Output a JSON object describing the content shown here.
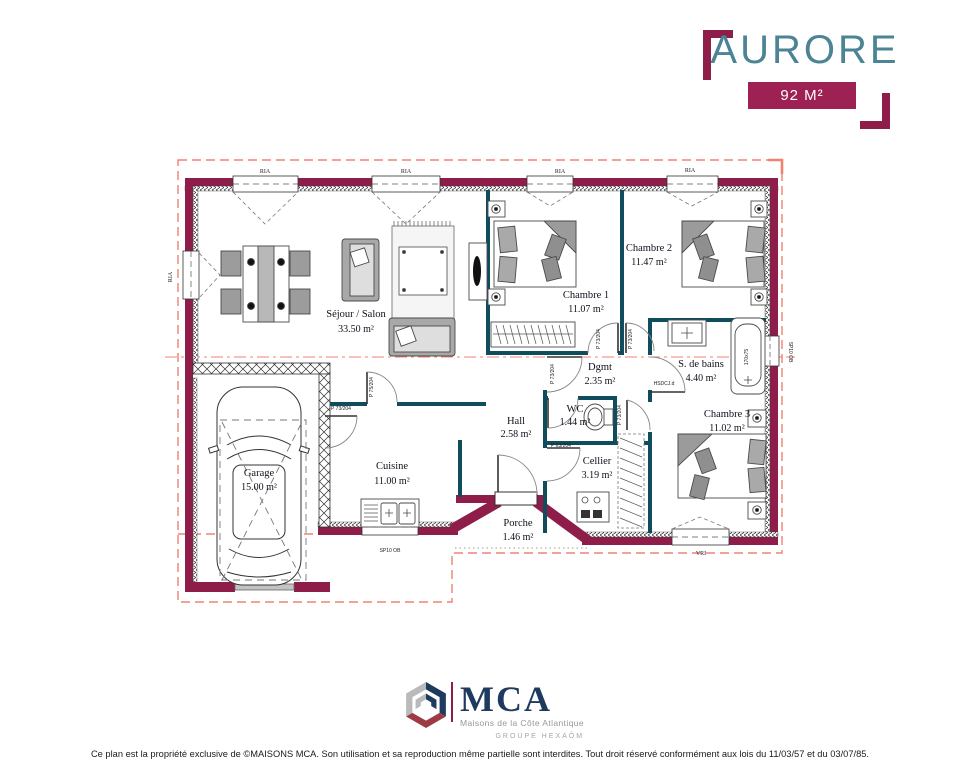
{
  "header": {
    "title": "AURORE",
    "area_badge": "92 M²"
  },
  "rooms": [
    {
      "name": "Séjour / Salon",
      "area": "33.50 m²"
    },
    {
      "name": "Chambre 1",
      "area": "11.07 m²"
    },
    {
      "name": "Chambre 2",
      "area": "11.47 m²"
    },
    {
      "name": "Chambre 3",
      "area": "11.02 m²"
    },
    {
      "name": "S. de bains",
      "area": "4.40 m²"
    },
    {
      "name": "Dgmt",
      "area": "2.35 m²"
    },
    {
      "name": "WC",
      "area": "1.44 m²"
    },
    {
      "name": "Hall",
      "area": "2.58 m²"
    },
    {
      "name": "Cuisine",
      "area": "11.00 m²"
    },
    {
      "name": "Cellier",
      "area": "3.19 m²"
    },
    {
      "name": "Porche",
      "area": "1.46 m²"
    },
    {
      "name": "Garage",
      "area": "15.00 m²"
    }
  ],
  "labels": {
    "window_top": "RIA",
    "window_side": "RIA",
    "window_roller": "VRI",
    "window_small": "SP10 OB",
    "door_73": "P 73/204",
    "door_75": "P 75/204",
    "door_63": "P 63/204",
    "door_bath": "HSDCJ.d",
    "bathtub_size": "170x75"
  },
  "logo": {
    "acronym": "MCA",
    "subtitle": "Maisons de la Côte Atlantique",
    "group": "GROUPE HEXAÔM"
  },
  "footer": "Ce plan est la propriété exclusive de ©MAISONS MCA. Son utilisation et sa reproduction même partielle sont interdites. Tout droit réservé conformément aux lois du 11/03/57 et du 03/07/85.",
  "colors": {
    "wall_exterior": "#8e1d49",
    "wall_interior": "#0f4d5c",
    "badge": "#9e2153",
    "title": "#4b8494",
    "dashed_outline": "#f08273",
    "logo_navy": "#1e3a5f"
  }
}
